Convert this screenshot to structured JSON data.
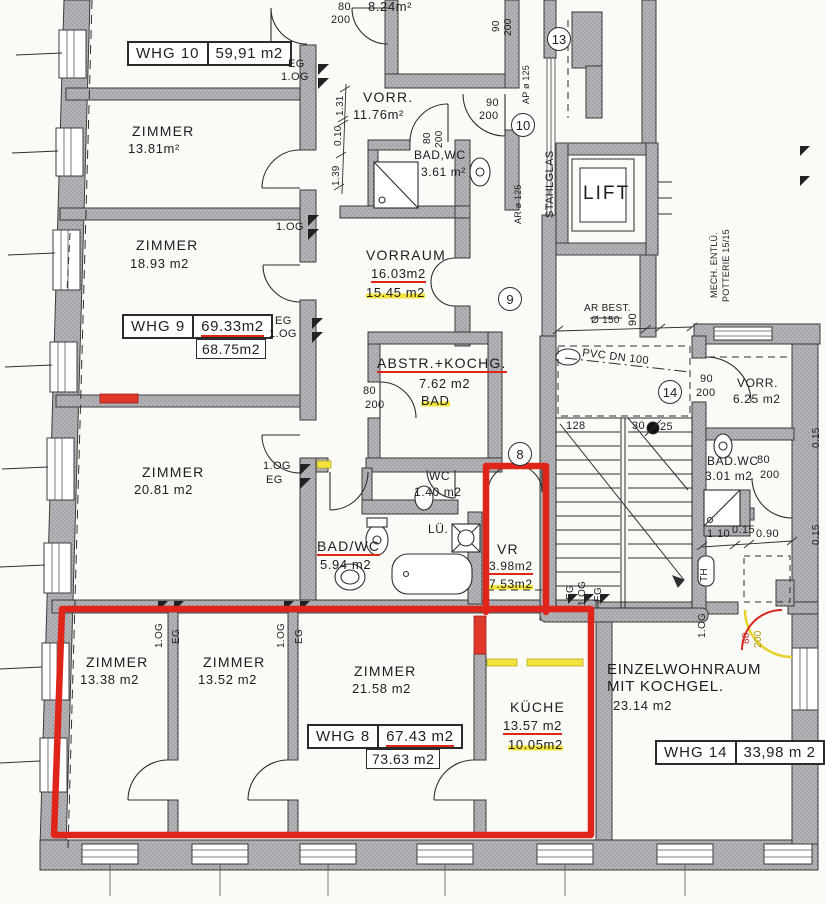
{
  "whg_boxes": {
    "whg10": {
      "name": "WHG 10",
      "area": "59,91 m2"
    },
    "whg9": {
      "name": "WHG 9",
      "area": "69.33m2",
      "revised": "68.75m2"
    },
    "whg8": {
      "name": "WHG 8",
      "area": "67.43 m2",
      "revised": "73.63 m2"
    },
    "whg14": {
      "name": "WHG 14",
      "area": "33,98 m 2"
    }
  },
  "rooms": {
    "z1381": {
      "name": "ZIMMER",
      "area": "13.81m²"
    },
    "z1893": {
      "name": "ZIMMER",
      "area": "18.93 m2"
    },
    "z2081": {
      "name": "ZIMMER",
      "area": "20.81 m2"
    },
    "z1338": {
      "name": "ZIMMER",
      "area": "13.38 m2"
    },
    "z1352": {
      "name": "ZIMMER",
      "area": "13.52 m2"
    },
    "z2158": {
      "name": "ZIMMER",
      "area": "21.58 m2"
    },
    "kueche": {
      "name": "KÜCHE",
      "area": "13.57 m2",
      "revised": "10.05m2"
    },
    "vorr_top": {
      "name": "VORR.",
      "area": "11.76m²"
    },
    "vorraum": {
      "name": "VORRAUM",
      "area": "16.03m2",
      "revised": "15.45 m2"
    },
    "badwc_top": {
      "name": "BAD,WC",
      "area": "3.61 m²"
    },
    "abstr": {
      "name": "ABSTR.+KOCHG.",
      "area": "7.62 m2",
      "note": "BAD"
    },
    "wc": {
      "name": "WC",
      "area": "1.40 m2"
    },
    "badwc_mid": {
      "name": "BAD/WC",
      "area": "5.94 m2"
    },
    "vr": {
      "name": "VR",
      "area": "3.98m2",
      "revised": "7.53m2"
    },
    "r824": {
      "area": "8.24m²"
    },
    "vorr_right": {
      "name": "VORR.",
      "area": "6.25 m2"
    },
    "badwc_right": {
      "name": "BAD.WC",
      "area": "3.01 m2"
    },
    "einzel": {
      "line1": "EINZELWOHNRAUM",
      "line2": "MIT KOCHGEL.",
      "area": "23.14 m2"
    },
    "lift": {
      "name": "LIFT"
    }
  },
  "small": {
    "eg": "EG",
    "og": "1.OG",
    "lue": "LÜ.",
    "th": "TH",
    "stahlglas": "STAHLGLAS",
    "mech1": "MECH. ENTLÜ.",
    "mech2": "POTTERIE 15/15",
    "arbest": "AR  BEST.",
    "arbest_d": "Ø 150",
    "pvc": "PVC  DN  100",
    "ap125": "AP ø 125",
    "ar125": "AR ø 125"
  },
  "dims": {
    "v131": "1.31",
    "v010": "0.10",
    "v139": "1.39",
    "v110": "1.10",
    "v015": "0.15",
    "v090": "0.90",
    "s128": "128",
    "s30": "30",
    "s25": "25",
    "s90": "90",
    "d80": "80",
    "d200": "200",
    "d90": "90",
    "r015": "0.15"
  },
  "circles": {
    "c13": "13",
    "c10": "10",
    "c9": "9",
    "c8": "8",
    "c14": "14"
  }
}
